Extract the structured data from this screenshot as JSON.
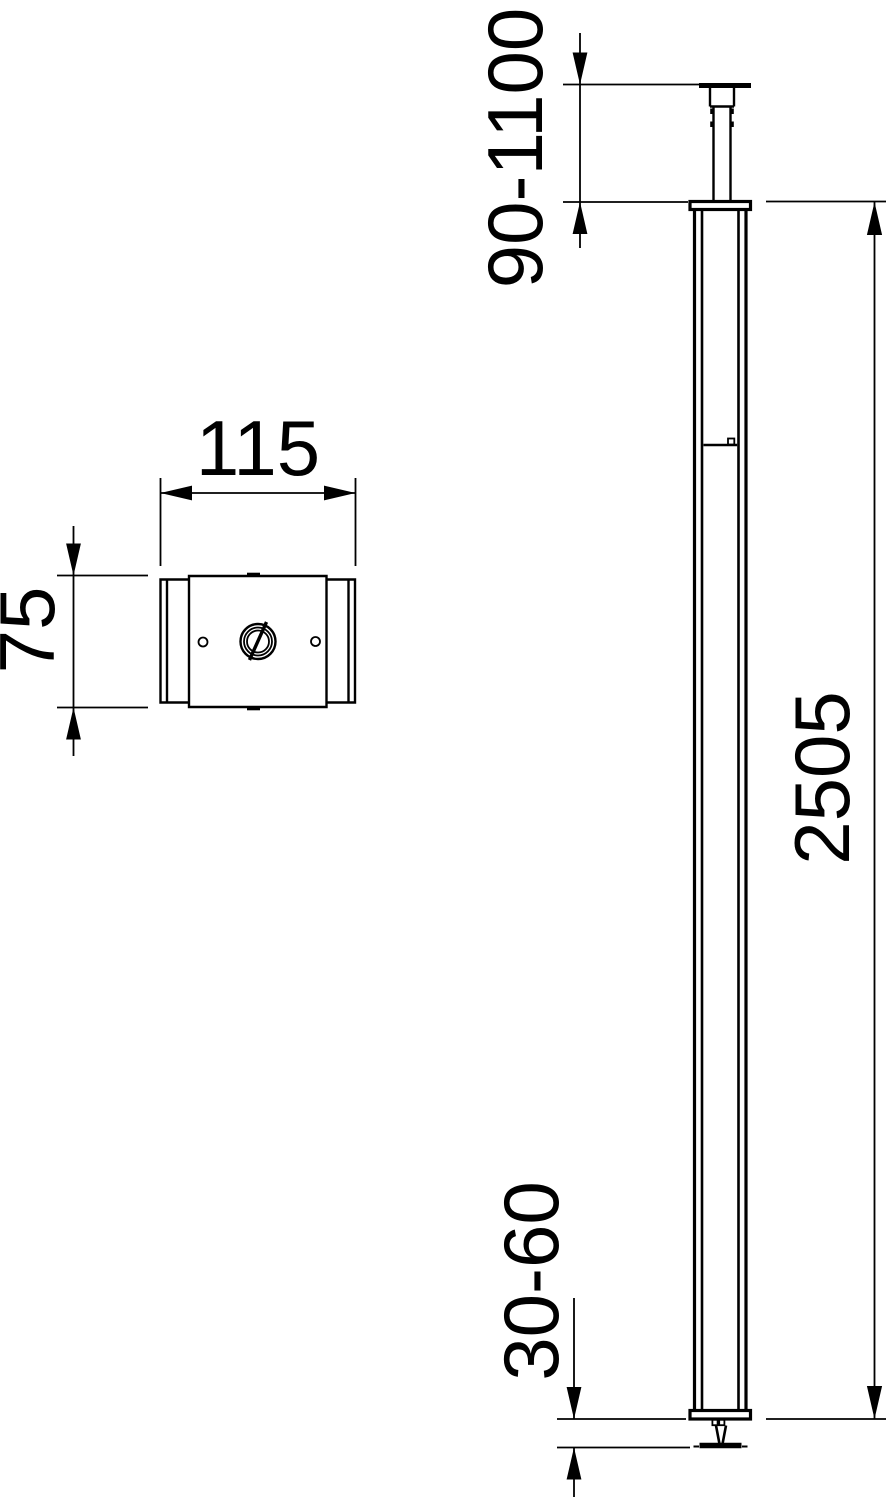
{
  "page": {
    "background_color": "#ffffff",
    "line_color": "#000000"
  },
  "views": {
    "cross_section": {
      "width_label": "115",
      "height_label": "75"
    },
    "elevation": {
      "ceiling_adjust_label": "90-1100",
      "column_height_label": "2505",
      "floor_adjust_label": "30-60"
    }
  }
}
